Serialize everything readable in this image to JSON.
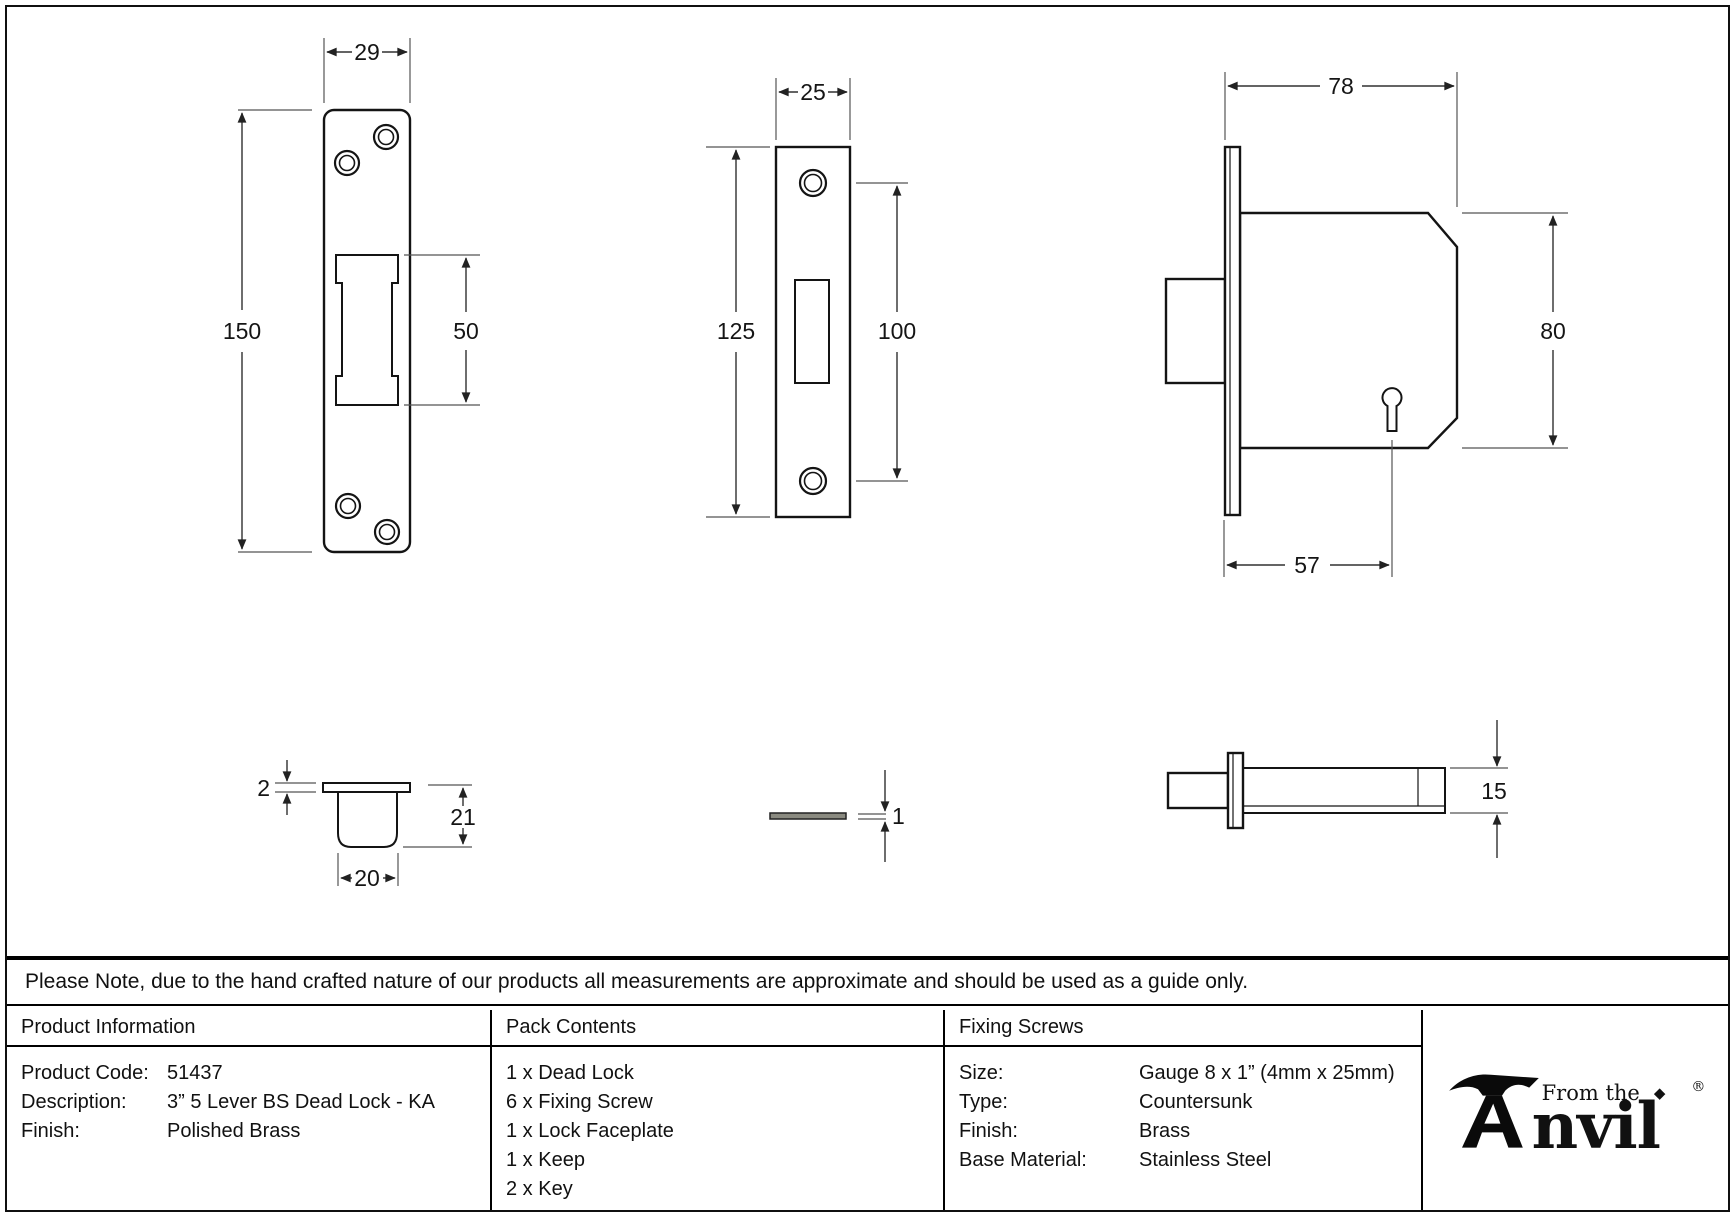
{
  "note": "Please Note, due to the hand crafted nature of our products all measurements are approximate and should be used as a guide only.",
  "drawings": {
    "keep_front": {
      "width": "29",
      "height": "150",
      "cutout_height": "50"
    },
    "faceplate_front": {
      "width": "25",
      "height": "125",
      "hole_spacing": "100"
    },
    "lock_body_side": {
      "width": "78",
      "height": "80",
      "backset": "57"
    },
    "keep_box_side": {
      "flange_thickness": "2",
      "depth": "21",
      "width": "20"
    },
    "faceplate_edge": {
      "thickness": "1"
    },
    "lock_body_top": {
      "thickness": "15"
    }
  },
  "table": {
    "product_information": {
      "header": "Product Information",
      "rows": [
        {
          "label": "Product Code:",
          "value": "51437"
        },
        {
          "label": "Description:",
          "value": "3” 5 Lever BS Dead Lock - KA"
        },
        {
          "label": "Finish:",
          "value": "Polished Brass"
        }
      ]
    },
    "pack_contents": {
      "header": "Pack Contents",
      "items": [
        "1 x Dead Lock",
        "6 x Fixing Screw",
        "1 x Lock Faceplate",
        "1 x Keep",
        "2 x Key"
      ]
    },
    "fixing_screws": {
      "header": "Fixing Screws",
      "rows": [
        {
          "label": "Size:",
          "value": "Gauge 8 x 1” (4mm x 25mm)"
        },
        {
          "label": "Type:",
          "value": "Countersunk"
        },
        {
          "label": "Finish:",
          "value": "Brass"
        },
        {
          "label": "Base Material:",
          "value": "Stainless Steel"
        }
      ]
    }
  },
  "logo": {
    "text_small": "From the",
    "text_large_rest": "nvil",
    "diamond_glyph": "◆",
    "registered_mark": "®"
  },
  "colors": {
    "line": "#141414",
    "background": "#ffffff"
  }
}
